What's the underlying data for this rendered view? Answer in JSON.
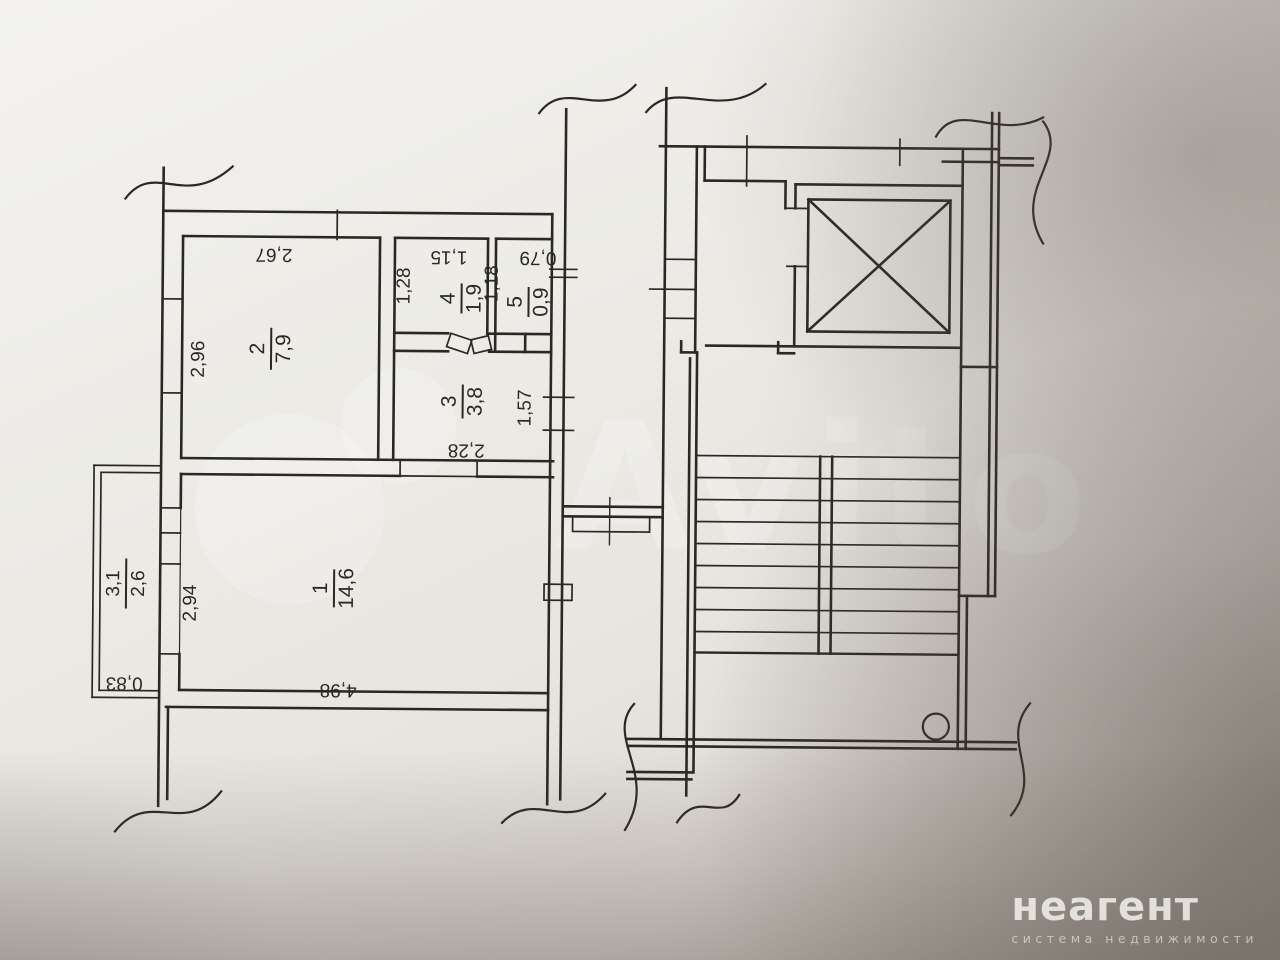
{
  "document": {
    "type": "apartment floor plan photo"
  },
  "rooms": {
    "r1": {
      "number": "1",
      "area": "14,6"
    },
    "r2": {
      "number": "2",
      "area": "7,9"
    },
    "r3": {
      "number": "3",
      "area": "3,8"
    },
    "r4": {
      "number": "4",
      "area": "1,9"
    },
    "r5": {
      "number": "5",
      "area": "0,9"
    }
  },
  "balcony": {
    "upper": "3,1",
    "lower": "2,6"
  },
  "dims": {
    "d267": "2,67",
    "d296": "2,96",
    "d128": "1,28",
    "d115": "1,15",
    "d079": "0,79",
    "d118": "1,18",
    "d157": "1,57",
    "d228": "2,28",
    "d294": "2,94",
    "d498": "4,98",
    "d083": "0,83"
  },
  "watermarks": {
    "avito": "Avito",
    "brand": "неагент",
    "brand_tagline": "система недвижимости"
  },
  "colors": {
    "ink": "#2b2824",
    "paper": "#ecebe6",
    "shadow": "#4a423a",
    "watermark": "#ffffff"
  }
}
